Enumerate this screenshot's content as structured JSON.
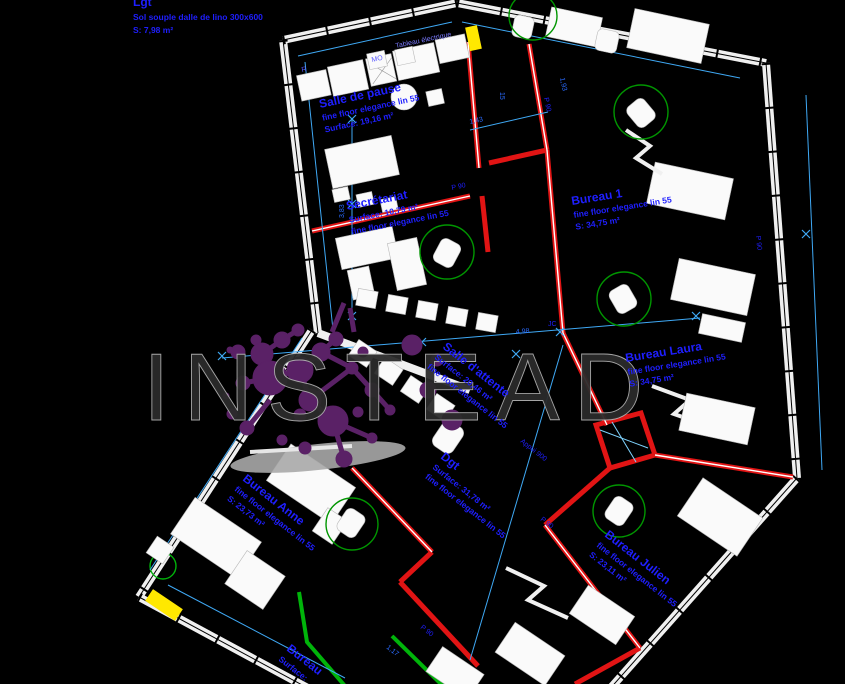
{
  "watermark": {
    "text": "INSTEAD"
  },
  "rooms": [
    {
      "name": "Lgt",
      "l2": "Sol souple dalle de lino 300x600",
      "l3": "S: 7,98 m²"
    },
    {
      "name": "Salle de pause",
      "l2": "fine floor elegance lin 55",
      "l3": "Surface: 19,16 m²"
    },
    {
      "name": "Secrétariat",
      "l2": "Surface: 10,79 m²",
      "l3": "fine floor elegance lin 55"
    },
    {
      "name": "Bureau 1",
      "l2": "fine floor elegance lin 55",
      "l3": "S: 34,75 m²"
    },
    {
      "name": "Bureau Laura",
      "l2": "fine floor elegance lin 55",
      "l3": "S: 34,75 m²"
    },
    {
      "name": "Salle d'attente",
      "l2": "Surface: 20,46 m²",
      "l3": "fine floor elegance lin 55"
    },
    {
      "name": "Dgt",
      "l2": "Surface: 31,78 m²",
      "l3": "fine floor elegance lin 55"
    },
    {
      "name": "Bureau Anne",
      "l2": "fine floor elegance lin 55",
      "l3": "S: 23,73 m²"
    },
    {
      "name": "Bureau Julien",
      "l2": "fine floor elegance lin 55",
      "l3": "S: 23,11 m²"
    },
    {
      "name": "Bureau",
      "l2": "Surface:",
      "l3": ""
    }
  ],
  "small_labels": {
    "fridge": "R",
    "microwave": "MO",
    "panel": "Tableau électrique",
    "jc": "JC",
    "appui": "Appui 900",
    "door": "P 90"
  },
  "dimensions": {
    "a": "1,93",
    "b": "1,43",
    "c": "4,98",
    "d": "1,17",
    "e": "3,83",
    "f": "15"
  },
  "colors": {
    "background": "#000000",
    "exterior_wall": "#f0f0f0",
    "partition_red": "#e11414",
    "partition_green": "#00b40a",
    "dimension_blue": "#3fa9f5",
    "text_blue": "#1f1fff",
    "logo_purple": "#5a2166",
    "highlight_yellow": "#ffe800",
    "watermark_gray": "#2b2b2b"
  }
}
